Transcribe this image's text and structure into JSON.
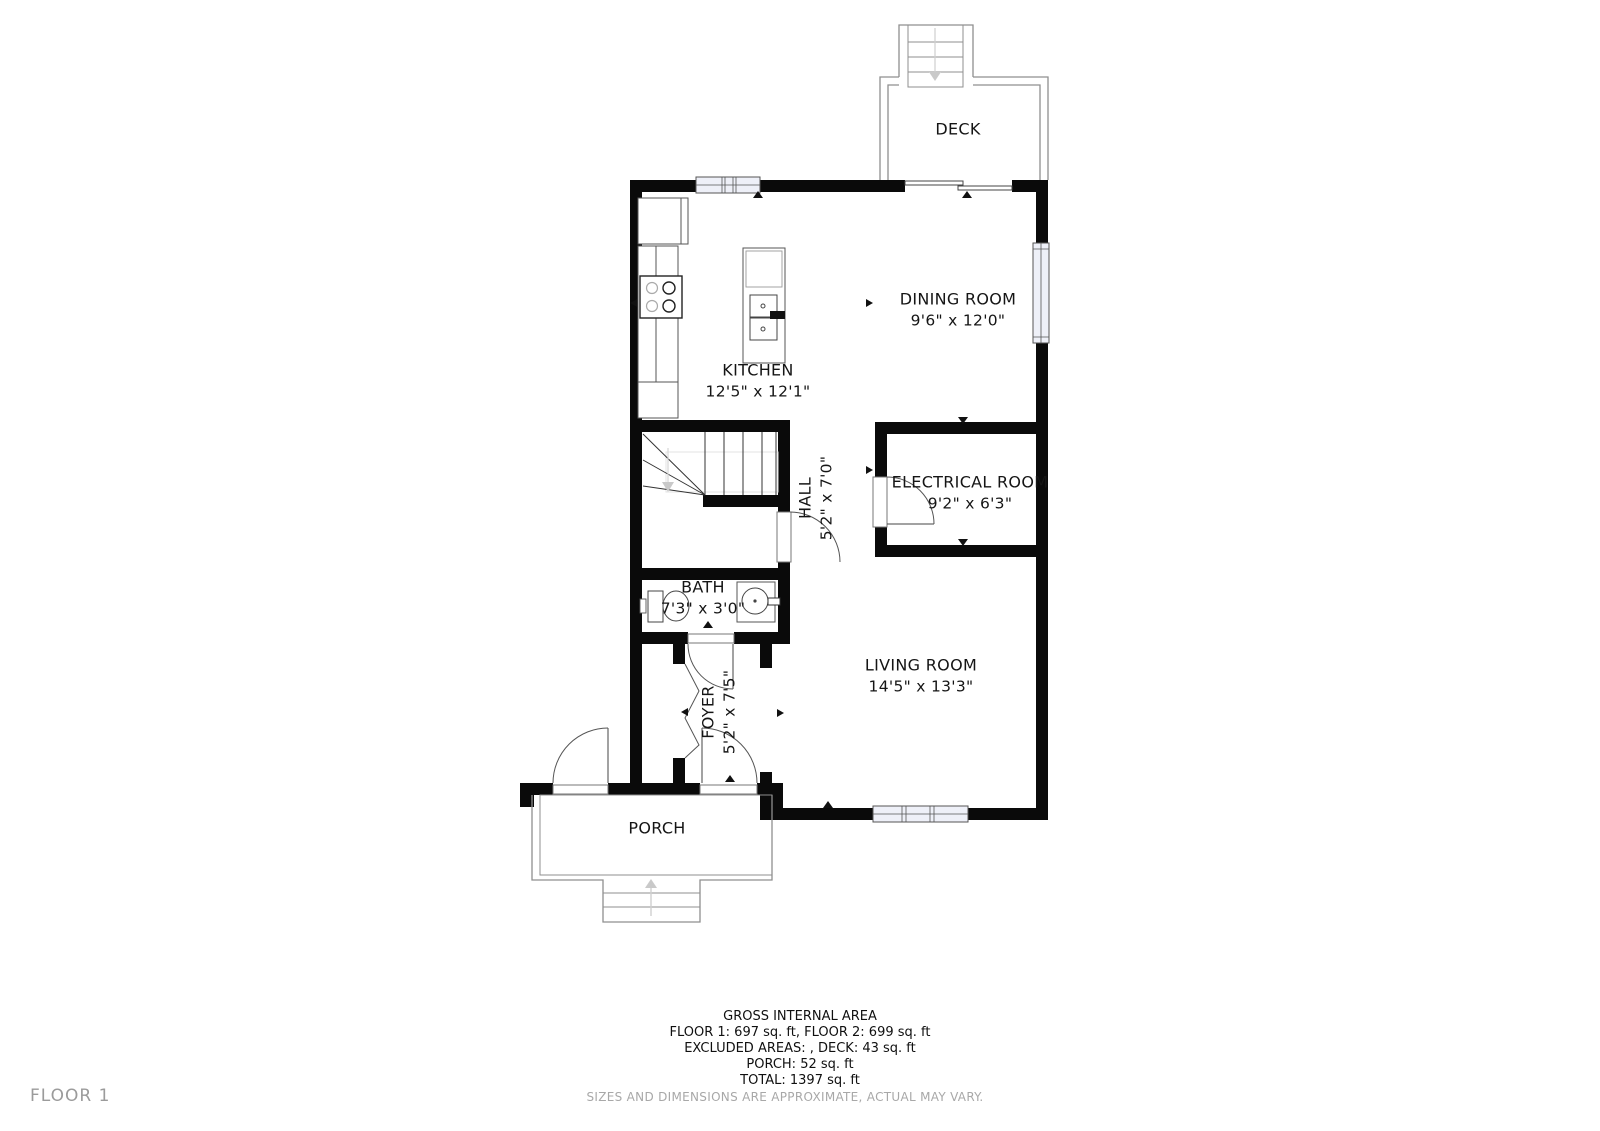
{
  "floor_label": "FLOOR 1",
  "disclaimer": "SIZES AND DIMENSIONS ARE APPROXIMATE, ACTUAL MAY VARY.",
  "summary": {
    "title": "GROSS INTERNAL AREA",
    "line1": "FLOOR 1: 697 sq. ft, FLOOR 2: 699 sq. ft",
    "line2": "EXCLUDED AREAS: , DECK: 43 sq. ft",
    "line3": "PORCH: 52 sq. ft",
    "line4": "TOTAL: 1397 sq. ft"
  },
  "rooms": {
    "deck": {
      "name": "DECK",
      "dims": ""
    },
    "dining": {
      "name": "DINING ROOM",
      "dims": "9'6\" x 12'0\""
    },
    "kitchen": {
      "name": "KITCHEN",
      "dims": "12'5\" x 12'1\""
    },
    "electrical": {
      "name": "ELECTRICAL ROOM",
      "dims": "9'2\" x 6'3\""
    },
    "hall": {
      "name": "HALL",
      "dims": "5'2\" x 7'0\""
    },
    "bath": {
      "name": "BATH",
      "dims": "7'3\" x 3'0\""
    },
    "living": {
      "name": "LIVING ROOM",
      "dims": "14'5\" x 13'3\""
    },
    "foyer": {
      "name": "FOYER",
      "dims": "5'2\" x 7'5\""
    },
    "porch": {
      "name": "PORCH",
      "dims": ""
    }
  },
  "colors": {
    "wall": "#0a0a0a",
    "thin_line": "#555555",
    "light_line": "#999999",
    "window_fill": "#eef0f8",
    "arrow_gray": "#c9c9c9",
    "muted_text": "#9b9b9b"
  }
}
